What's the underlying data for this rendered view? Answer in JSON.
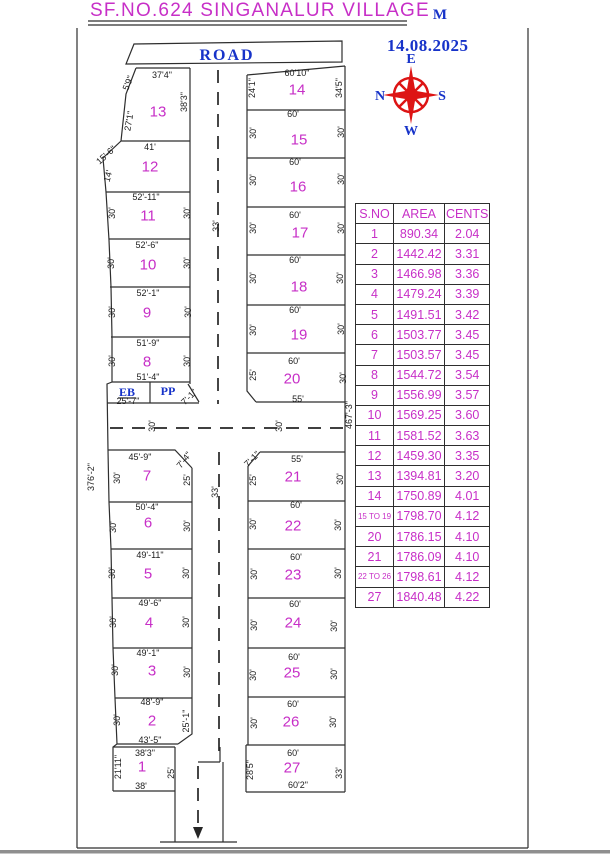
{
  "title": "SF.NO.624 SINGANALUR VILLAGE",
  "corner_mark": "M",
  "date": "14.08.2025",
  "road_label": "ROAD",
  "eb_label": "EB",
  "pp_label": "PP",
  "compass": {
    "top": "E",
    "left": "N",
    "right": "S",
    "bottom": "W"
  },
  "colors": {
    "magenta": "#C72FC7",
    "blue": "#1733C9",
    "red": "#DD1414",
    "line": "#2e2e2e"
  },
  "table": {
    "headers": [
      "S.NO",
      "AREA",
      "CENTS"
    ],
    "rows": [
      [
        "1",
        "890.34",
        "2.04"
      ],
      [
        "2",
        "1442.42",
        "3.31"
      ],
      [
        "3",
        "1466.98",
        "3.36"
      ],
      [
        "4",
        "1479.24",
        "3.39"
      ],
      [
        "5",
        "1491.51",
        "3.42"
      ],
      [
        "6",
        "1503.77",
        "3.45"
      ],
      [
        "7",
        "1503.57",
        "3.45"
      ],
      [
        "8",
        "1544.72",
        "3.54"
      ],
      [
        "9",
        "1556.99",
        "3.57"
      ],
      [
        "10",
        "1569.25",
        "3.60"
      ],
      [
        "11",
        "1581.52",
        "3.63"
      ],
      [
        "12",
        "1459.30",
        "3.35"
      ],
      [
        "13",
        "1394.81",
        "3.20"
      ],
      [
        "14",
        "1750.89",
        "4.01"
      ],
      [
        "15 TO 19",
        "1798.70",
        "4.12"
      ],
      [
        "20",
        "1786.15",
        "4.10"
      ],
      [
        "21",
        "1786.09",
        "4.10"
      ],
      [
        "22 TO 26",
        "1798.61",
        "4.12"
      ],
      [
        "27",
        "1840.48",
        "4.22"
      ]
    ]
  },
  "plot_numbers": [
    {
      "n": "1",
      "x": 142,
      "y": 767
    },
    {
      "n": "2",
      "x": 152,
      "y": 721
    },
    {
      "n": "3",
      "x": 152,
      "y": 671
    },
    {
      "n": "4",
      "x": 149,
      "y": 623
    },
    {
      "n": "5",
      "x": 148,
      "y": 574
    },
    {
      "n": "6",
      "x": 148,
      "y": 523
    },
    {
      "n": "7",
      "x": 147,
      "y": 476
    },
    {
      "n": "8",
      "x": 147,
      "y": 362
    },
    {
      "n": "9",
      "x": 147,
      "y": 313
    },
    {
      "n": "10",
      "x": 148,
      "y": 265
    },
    {
      "n": "11",
      "x": 148,
      "y": 216
    },
    {
      "n": "12",
      "x": 150,
      "y": 167
    },
    {
      "n": "13",
      "x": 158,
      "y": 112
    },
    {
      "n": "14",
      "x": 297,
      "y": 90
    },
    {
      "n": "15",
      "x": 299,
      "y": 140
    },
    {
      "n": "16",
      "x": 298,
      "y": 187
    },
    {
      "n": "17",
      "x": 300,
      "y": 233
    },
    {
      "n": "18",
      "x": 299,
      "y": 287
    },
    {
      "n": "19",
      "x": 299,
      "y": 335
    },
    {
      "n": "20",
      "x": 292,
      "y": 379
    },
    {
      "n": "21",
      "x": 293,
      "y": 477
    },
    {
      "n": "22",
      "x": 293,
      "y": 526
    },
    {
      "n": "23",
      "x": 293,
      "y": 575
    },
    {
      "n": "24",
      "x": 293,
      "y": 623
    },
    {
      "n": "25",
      "x": 292,
      "y": 673
    },
    {
      "n": "26",
      "x": 291,
      "y": 722
    },
    {
      "n": "27",
      "x": 292,
      "y": 768
    }
  ],
  "dimensions": [
    {
      "t": "37'4\"",
      "x": 162,
      "y": 75,
      "r": 0
    },
    {
      "t": "5'9\"",
      "x": 128,
      "y": 83,
      "r": -68
    },
    {
      "t": "38'3\"",
      "x": 184,
      "y": 102,
      "r": -90
    },
    {
      "t": "27'1\"",
      "x": 129,
      "y": 121,
      "r": -80
    },
    {
      "t": "41'",
      "x": 150,
      "y": 147,
      "r": 0
    },
    {
      "t": "15'-6\"",
      "x": 106,
      "y": 155,
      "r": -42
    },
    {
      "t": "14'",
      "x": 108,
      "y": 176,
      "r": -75
    },
    {
      "t": "52'-11\"",
      "x": 146,
      "y": 197,
      "r": 0
    },
    {
      "t": "30'",
      "x": 112,
      "y": 213,
      "r": -90
    },
    {
      "t": "30'",
      "x": 187,
      "y": 213,
      "r": -90
    },
    {
      "t": "52'-6\"",
      "x": 147,
      "y": 245,
      "r": 0
    },
    {
      "t": "30'",
      "x": 111,
      "y": 263,
      "r": -90
    },
    {
      "t": "30'",
      "x": 187,
      "y": 263,
      "r": -90
    },
    {
      "t": "52'-1\"",
      "x": 148,
      "y": 293,
      "r": 0
    },
    {
      "t": "30'",
      "x": 112,
      "y": 312,
      "r": -90
    },
    {
      "t": "30'",
      "x": 188,
      "y": 312,
      "r": -90
    },
    {
      "t": "51'-9\"",
      "x": 148,
      "y": 343,
      "r": 0
    },
    {
      "t": "30'",
      "x": 112,
      "y": 361,
      "r": -90
    },
    {
      "t": "30'",
      "x": 187,
      "y": 361,
      "r": -90
    },
    {
      "t": "51'-4\"",
      "x": 148,
      "y": 377,
      "r": 0
    },
    {
      "t": "25'-7\"",
      "x": 128,
      "y": 401,
      "r": 0
    },
    {
      "t": "7'-1\"",
      "x": 189,
      "y": 397,
      "r": -45
    },
    {
      "t": "33'",
      "x": 216,
      "y": 226,
      "r": -90
    },
    {
      "t": "30'",
      "x": 152,
      "y": 426,
      "r": -90
    },
    {
      "t": "30'",
      "x": 279,
      "y": 426,
      "r": -90
    },
    {
      "t": "55'",
      "x": 298,
      "y": 399,
      "r": 0
    },
    {
      "t": "467'-3\"",
      "x": 349,
      "y": 415,
      "r": -90
    },
    {
      "t": "376'-2\"",
      "x": 91,
      "y": 477,
      "r": -90
    },
    {
      "t": "45'-9\"",
      "x": 140,
      "y": 457,
      "r": 0
    },
    {
      "t": "7'-4\"",
      "x": 184,
      "y": 460,
      "r": -52
    },
    {
      "t": "30'",
      "x": 117,
      "y": 478,
      "r": -90
    },
    {
      "t": "25'",
      "x": 187,
      "y": 480,
      "r": -90
    },
    {
      "t": "50'-4\"",
      "x": 147,
      "y": 507,
      "r": 0
    },
    {
      "t": "30'",
      "x": 113,
      "y": 527,
      "r": -90
    },
    {
      "t": "30'",
      "x": 187,
      "y": 526,
      "r": -90
    },
    {
      "t": "49'-11\"",
      "x": 150,
      "y": 555,
      "r": 0
    },
    {
      "t": "30'",
      "x": 112,
      "y": 573,
      "r": -90
    },
    {
      "t": "30'",
      "x": 186,
      "y": 573,
      "r": -90
    },
    {
      "t": "33'",
      "x": 215,
      "y": 492,
      "r": -90
    },
    {
      "t": "49'-6\"",
      "x": 150,
      "y": 603,
      "r": 0
    },
    {
      "t": "30'",
      "x": 113,
      "y": 622,
      "r": -90
    },
    {
      "t": "30'",
      "x": 186,
      "y": 622,
      "r": -90
    },
    {
      "t": "49'-1\"",
      "x": 148,
      "y": 653,
      "r": 0
    },
    {
      "t": "30'",
      "x": 115,
      "y": 670,
      "r": -90
    },
    {
      "t": "30'",
      "x": 187,
      "y": 672,
      "r": -90
    },
    {
      "t": "48'-9\"",
      "x": 152,
      "y": 702,
      "r": 0
    },
    {
      "t": "30'",
      "x": 117,
      "y": 720,
      "r": -90
    },
    {
      "t": "25'-1\"",
      "x": 186,
      "y": 721,
      "r": -90
    },
    {
      "t": "43'-5\"",
      "x": 150,
      "y": 740,
      "r": 0
    },
    {
      "t": "38'3\"",
      "x": 145,
      "y": 753,
      "r": 0
    },
    {
      "t": "21'11\"",
      "x": 118,
      "y": 767,
      "r": -90
    },
    {
      "t": "25'",
      "x": 171,
      "y": 773,
      "r": -90
    },
    {
      "t": "38'",
      "x": 141,
      "y": 786,
      "r": 0
    },
    {
      "t": "60'10\"",
      "x": 297,
      "y": 73,
      "r": 0
    },
    {
      "t": "24'1\"",
      "x": 252,
      "y": 88,
      "r": -90
    },
    {
      "t": "34'5\"",
      "x": 339,
      "y": 88,
      "r": -90
    },
    {
      "t": "60'",
      "x": 293,
      "y": 114,
      "r": 0
    },
    {
      "t": "30'",
      "x": 253,
      "y": 133,
      "r": -90
    },
    {
      "t": "30'",
      "x": 341,
      "y": 132,
      "r": -90
    },
    {
      "t": "60'",
      "x": 295,
      "y": 162,
      "r": 0
    },
    {
      "t": "30'",
      "x": 253,
      "y": 180,
      "r": -90
    },
    {
      "t": "30'",
      "x": 341,
      "y": 179,
      "r": -90
    },
    {
      "t": "60'",
      "x": 295,
      "y": 215,
      "r": 0
    },
    {
      "t": "30'",
      "x": 253,
      "y": 228,
      "r": -90
    },
    {
      "t": "30'",
      "x": 341,
      "y": 228,
      "r": -90
    },
    {
      "t": "60'",
      "x": 295,
      "y": 260,
      "r": 0
    },
    {
      "t": "30'",
      "x": 253,
      "y": 278,
      "r": -90
    },
    {
      "t": "30'",
      "x": 340,
      "y": 278,
      "r": -90
    },
    {
      "t": "60'",
      "x": 295,
      "y": 310,
      "r": 0
    },
    {
      "t": "30'",
      "x": 253,
      "y": 330,
      "r": -90
    },
    {
      "t": "30'",
      "x": 341,
      "y": 329,
      "r": -90
    },
    {
      "t": "60'",
      "x": 294,
      "y": 361,
      "r": 0
    },
    {
      "t": "25'",
      "x": 253,
      "y": 375,
      "r": -90
    },
    {
      "t": "30'",
      "x": 343,
      "y": 378,
      "r": -90
    },
    {
      "t": "7'-1\"",
      "x": 252,
      "y": 459,
      "r": -45
    },
    {
      "t": "55'",
      "x": 297,
      "y": 459,
      "r": 0
    },
    {
      "t": "25'",
      "x": 253,
      "y": 480,
      "r": -90
    },
    {
      "t": "30'",
      "x": 340,
      "y": 479,
      "r": -90
    },
    {
      "t": "60'",
      "x": 296,
      "y": 505,
      "r": 0
    },
    {
      "t": "30'",
      "x": 253,
      "y": 524,
      "r": -90
    },
    {
      "t": "30'",
      "x": 338,
      "y": 525,
      "r": -90
    },
    {
      "t": "60'",
      "x": 296,
      "y": 557,
      "r": 0
    },
    {
      "t": "30'",
      "x": 254,
      "y": 574,
      "r": -90
    },
    {
      "t": "30'",
      "x": 338,
      "y": 573,
      "r": -90
    },
    {
      "t": "60'",
      "x": 295,
      "y": 604,
      "r": 0
    },
    {
      "t": "30'",
      "x": 254,
      "y": 625,
      "r": -90
    },
    {
      "t": "30'",
      "x": 334,
      "y": 626,
      "r": -90
    },
    {
      "t": "60'",
      "x": 294,
      "y": 657,
      "r": 0
    },
    {
      "t": "30'",
      "x": 253,
      "y": 675,
      "r": -90
    },
    {
      "t": "30'",
      "x": 334,
      "y": 674,
      "r": -90
    },
    {
      "t": "60'",
      "x": 293,
      "y": 704,
      "r": 0
    },
    {
      "t": "30'",
      "x": 254,
      "y": 723,
      "r": -90
    },
    {
      "t": "30'",
      "x": 333,
      "y": 722,
      "r": -90
    },
    {
      "t": "60'",
      "x": 293,
      "y": 753,
      "r": 0
    },
    {
      "t": "28'5\"",
      "x": 250,
      "y": 770,
      "r": -90
    },
    {
      "t": "33'",
      "x": 339,
      "y": 773,
      "r": -90
    },
    {
      "t": "60'2\"",
      "x": 298,
      "y": 785,
      "r": 0
    }
  ]
}
